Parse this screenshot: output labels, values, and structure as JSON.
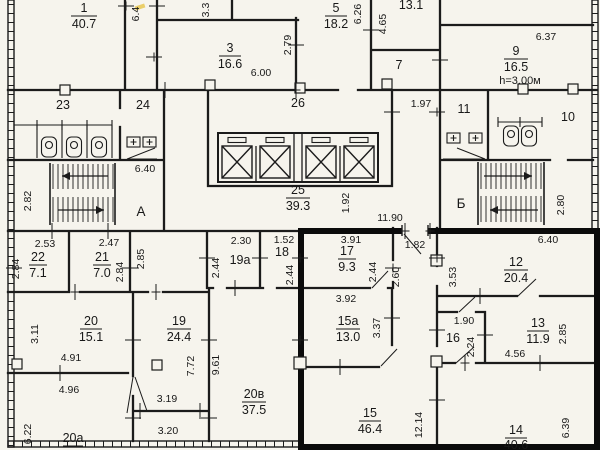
{
  "colors": {
    "paper": "#f6f4ed",
    "ink": "#1b1b1b",
    "apartment_outline": "#0b0b0b",
    "marker": "#e6c23c"
  },
  "axes": {
    "a": "А",
    "b": "Б"
  },
  "rooms": {
    "r1": {
      "num": "1",
      "area": "40.7"
    },
    "r3": {
      "num": "3",
      "area": "16.6"
    },
    "r5": {
      "num": "5",
      "area": "18.2"
    },
    "r8": {
      "area": "13.1"
    },
    "r9": {
      "num": "9",
      "area": "16.5",
      "note": "h=3.00м"
    },
    "r7": {
      "num": "7"
    },
    "r10": {
      "num": "10"
    },
    "r11": {
      "num": "11"
    },
    "r23": {
      "num": "23"
    },
    "r24": {
      "num": "24"
    },
    "r26": {
      "num": "26"
    },
    "r25": {
      "num": "25",
      "area": "39.3"
    },
    "r22": {
      "num": "22",
      "area": "7.1"
    },
    "r21": {
      "num": "21",
      "area": "7.0"
    },
    "r19a": {
      "num": "19а"
    },
    "r18": {
      "num": "18"
    },
    "r17": {
      "num": "17",
      "area": "9.3"
    },
    "r12": {
      "num": "12",
      "area": "20.4"
    },
    "r20": {
      "num": "20",
      "area": "15.1"
    },
    "r19": {
      "num": "19",
      "area": "24.4"
    },
    "r15a": {
      "num": "15а",
      "area": "13.0"
    },
    "r16": {
      "num": "16"
    },
    "r13": {
      "num": "13",
      "area": "11.9"
    },
    "r20a": {
      "num": "20а"
    },
    "r20v": {
      "num": "20в",
      "area": "37.5"
    },
    "r15": {
      "num": "15",
      "area": "46.4"
    },
    "r14": {
      "num": "14",
      "area": "40.6"
    }
  },
  "dims": {
    "top_6_4": "6.4",
    "top_3_3": "3.3",
    "d2_79": "2.79",
    "d6_00": "6.00",
    "d6_26": "6.26",
    "d4_65": "4.65",
    "d6_37": "6.37",
    "d1_97": "1.97",
    "d1_92": "1.92",
    "d11_90": "11.90",
    "d6_40a": "6.40",
    "d2_82": "2.82",
    "d2_80": "2.80",
    "d2_53": "2.53",
    "d2_84a": "2.84",
    "d2_47": "2.47",
    "d2_84b": "2.84",
    "d2_85a": "2.85",
    "d2_30": "2.30",
    "d2_44a": "2.44",
    "d1_52": "1.52",
    "d2_44b": "2.44",
    "d3_91": "3.91",
    "d2_44c": "2.44",
    "d1_82": "1.82",
    "d2_60": "2.60",
    "d3_53": "3.53",
    "d6_40b": "6.40",
    "d3_11": "3.11",
    "d4_91": "4.91",
    "d4_96": "4.96",
    "d6_22": "6.22",
    "d7_72": "7.72",
    "d9_61": "9.61",
    "d3_19": "3.19",
    "d3_20": "3.20",
    "d3_92": "3.92",
    "d3_37": "3.37",
    "d1_90": "1.90",
    "d2_24": "2.24",
    "d4_56": "4.56",
    "d2_85b": "2.85",
    "d12_14": "12.14",
    "d6_39": "6.39"
  }
}
